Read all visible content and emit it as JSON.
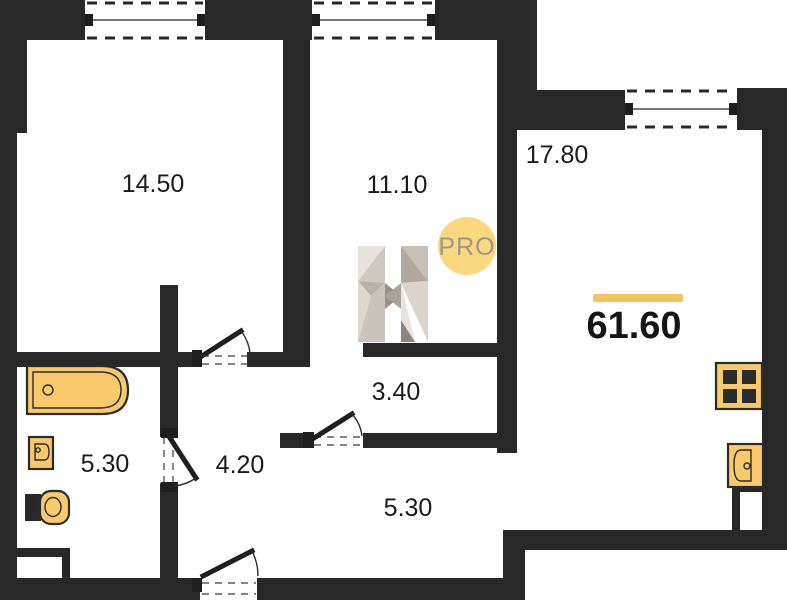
{
  "floorplan": {
    "rooms": [
      {
        "area": "14.50"
      },
      {
        "area": "11.10"
      },
      {
        "area": "17.80"
      },
      {
        "area": "3.40"
      },
      {
        "area": "4.20"
      },
      {
        "area": "5.30"
      },
      {
        "area": "5.30"
      }
    ],
    "total_area": "61.60",
    "logo": {
      "letter": "H",
      "badge": "PRO"
    },
    "colors": {
      "wall": "#282828",
      "fixture_fill": "#F8CA6B",
      "fixture_stroke": "#2B2B2B",
      "accent_bar": "#F2C45C",
      "badge_fill": "#FBD87E",
      "badge_text": "#9C968C",
      "label_text": "#1B1B1B"
    }
  }
}
